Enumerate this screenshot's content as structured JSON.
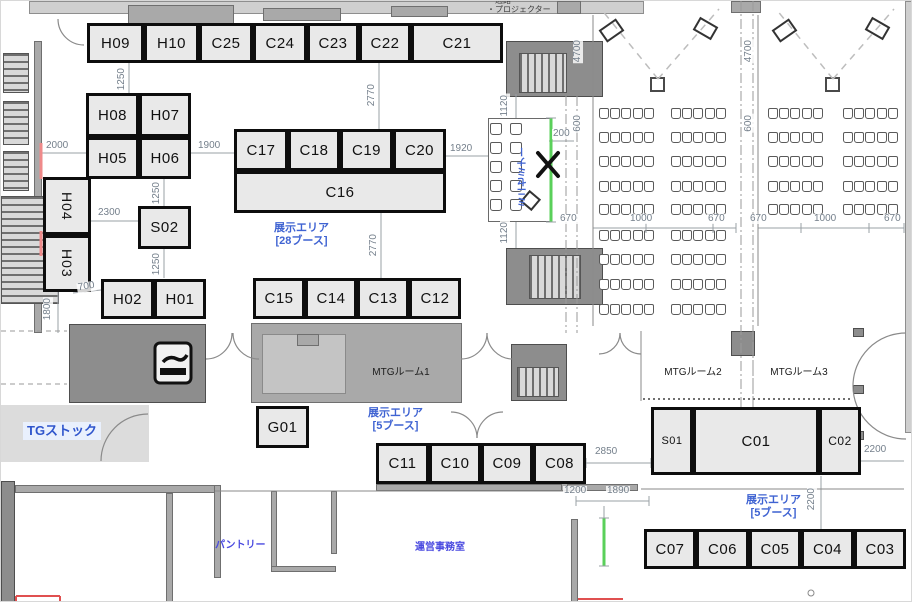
{
  "title": "展示エリア フロアマップ",
  "legend": {
    "line1": "・通路",
    "line2": "・プロジェクター"
  },
  "colors": {
    "booth_fill": "#e9e9e9",
    "booth_border": "#0d0d0d",
    "blue_label": "#3f63d2",
    "dim_text": "#75808c",
    "green_line": "#5ad05a",
    "red_accent": "#ef8a8a",
    "wall_dark": "#8d8d8d",
    "wall_mid": "#a9a9a9",
    "wall_light": "#cfcfcf"
  },
  "booths": [
    {
      "id": "H09",
      "x": 86,
      "y": 22,
      "w": 57,
      "h": 40
    },
    {
      "id": "H10",
      "x": 143,
      "y": 22,
      "w": 55,
      "h": 40
    },
    {
      "id": "C25",
      "x": 198,
      "y": 22,
      "w": 54,
      "h": 40
    },
    {
      "id": "C24",
      "x": 252,
      "y": 22,
      "w": 54,
      "h": 40
    },
    {
      "id": "C23",
      "x": 306,
      "y": 22,
      "w": 52,
      "h": 40
    },
    {
      "id": "C22",
      "x": 358,
      "y": 22,
      "w": 52,
      "h": 40
    },
    {
      "id": "C21",
      "x": 410,
      "y": 22,
      "w": 92,
      "h": 40
    },
    {
      "id": "H08",
      "x": 85,
      "y": 92,
      "w": 53,
      "h": 44
    },
    {
      "id": "H07",
      "x": 138,
      "y": 92,
      "w": 52,
      "h": 44
    },
    {
      "id": "H05",
      "x": 85,
      "y": 136,
      "w": 53,
      "h": 42
    },
    {
      "id": "H06",
      "x": 138,
      "y": 136,
      "w": 52,
      "h": 42
    },
    {
      "id": "H04",
      "x": 42,
      "y": 176,
      "w": 48,
      "h": 58,
      "vert": 1,
      "fs": 14
    },
    {
      "id": "H03",
      "x": 42,
      "y": 234,
      "w": 48,
      "h": 57,
      "vert": 1,
      "fs": 14
    },
    {
      "id": "S02",
      "x": 137,
      "y": 205,
      "w": 53,
      "h": 43
    },
    {
      "id": "H02",
      "x": 100,
      "y": 278,
      "w": 53,
      "h": 40
    },
    {
      "id": "H01",
      "x": 153,
      "y": 278,
      "w": 52,
      "h": 40
    },
    {
      "id": "C17",
      "x": 233,
      "y": 128,
      "w": 54,
      "h": 42
    },
    {
      "id": "C18",
      "x": 287,
      "y": 128,
      "w": 52,
      "h": 42
    },
    {
      "id": "C19",
      "x": 339,
      "y": 128,
      "w": 53,
      "h": 42
    },
    {
      "id": "C20",
      "x": 392,
      "y": 128,
      "w": 53,
      "h": 42
    },
    {
      "id": "C16",
      "x": 233,
      "y": 170,
      "w": 212,
      "h": 42
    },
    {
      "id": "C15",
      "x": 252,
      "y": 277,
      "w": 52,
      "h": 41
    },
    {
      "id": "C14",
      "x": 304,
      "y": 277,
      "w": 52,
      "h": 41
    },
    {
      "id": "C13",
      "x": 356,
      "y": 277,
      "w": 52,
      "h": 41
    },
    {
      "id": "C12",
      "x": 408,
      "y": 277,
      "w": 52,
      "h": 41
    },
    {
      "id": "G01",
      "x": 255,
      "y": 405,
      "w": 53,
      "h": 42
    },
    {
      "id": "C11",
      "x": 375,
      "y": 442,
      "w": 53,
      "h": 41
    },
    {
      "id": "C10",
      "x": 428,
      "y": 442,
      "w": 52,
      "h": 41
    },
    {
      "id": "C09",
      "x": 480,
      "y": 442,
      "w": 52,
      "h": 41
    },
    {
      "id": "C08",
      "x": 532,
      "y": 442,
      "w": 53,
      "h": 41
    },
    {
      "id": "S01",
      "x": 650,
      "y": 406,
      "w": 42,
      "h": 68,
      "fs": 11
    },
    {
      "id": "C01",
      "x": 692,
      "y": 406,
      "w": 126,
      "h": 68
    },
    {
      "id": "C02",
      "x": 818,
      "y": 406,
      "w": 42,
      "h": 68,
      "fs": 12
    },
    {
      "id": "C07",
      "x": 643,
      "y": 528,
      "w": 52,
      "h": 40
    },
    {
      "id": "C06",
      "x": 695,
      "y": 528,
      "w": 53,
      "h": 40
    },
    {
      "id": "C05",
      "x": 748,
      "y": 528,
      "w": 52,
      "h": 40
    },
    {
      "id": "C04",
      "x": 800,
      "y": 528,
      "w": 53,
      "h": 40
    },
    {
      "id": "C03",
      "x": 853,
      "y": 528,
      "w": 52,
      "h": 40
    }
  ],
  "rooms": [
    {
      "label": "MTGルーム1",
      "x": 355,
      "y": 362,
      "w": 90
    },
    {
      "label": "MTGルーム2",
      "x": 647,
      "y": 362,
      "w": 90
    },
    {
      "label": "MTGルーム3",
      "x": 753,
      "y": 362,
      "w": 90
    }
  ],
  "area_labels": [
    {
      "text": "展示エリア",
      "sub": "[28ブース]",
      "x": 258,
      "y": 221,
      "w": 85
    },
    {
      "text": "展示エリア",
      "sub": "[5ブース]",
      "x": 352,
      "y": 406,
      "w": 85
    },
    {
      "text": "展示エリア",
      "sub": "[5ブース]",
      "x": 730,
      "y": 493,
      "w": 85
    },
    {
      "text": "TGストック",
      "x": 22,
      "y": 421,
      "big": 1
    },
    {
      "text": "パントリー",
      "x": 214,
      "y": 539,
      "small": 1
    },
    {
      "text": "運営事務室",
      "x": 414,
      "y": 541,
      "small": 1
    },
    {
      "text": "ミニセミナー",
      "x": 517,
      "y": 146,
      "vert": 1
    }
  ],
  "dims": [
    {
      "text": "1250",
      "x": 116,
      "y": 66,
      "v": 1
    },
    {
      "text": "2000",
      "x": 44,
      "y": 140
    },
    {
      "text": "1900",
      "x": 196,
      "y": 140
    },
    {
      "text": "1250",
      "x": 151,
      "y": 180,
      "v": 1
    },
    {
      "text": "2300",
      "x": 96,
      "y": 207
    },
    {
      "text": "1250",
      "x": 151,
      "y": 251,
      "v": 1
    },
    {
      "text": "700",
      "x": 76,
      "y": 281,
      "slant": 1
    },
    {
      "text": "1800",
      "x": 42,
      "y": 296,
      "v": 1
    },
    {
      "text": "2770",
      "x": 366,
      "y": 82,
      "v": 1
    },
    {
      "text": "2770",
      "x": 368,
      "y": 232,
      "v": 1
    },
    {
      "text": "1920",
      "x": 448,
      "y": 143
    },
    {
      "text": "1120",
      "x": 499,
      "y": 93,
      "v": 1
    },
    {
      "text": "200",
      "x": 551,
      "y": 128
    },
    {
      "text": "1120",
      "x": 499,
      "y": 220,
      "v": 1
    },
    {
      "text": "4700",
      "x": 572,
      "y": 38,
      "v": 1
    },
    {
      "text": "600",
      "x": 572,
      "y": 113,
      "v": 1
    },
    {
      "text": "4700",
      "x": 743,
      "y": 38,
      "v": 1
    },
    {
      "text": "600",
      "x": 743,
      "y": 113,
      "v": 1
    },
    {
      "text": "670",
      "x": 558,
      "y": 213
    },
    {
      "text": "1000",
      "x": 628,
      "y": 213
    },
    {
      "text": "670",
      "x": 706,
      "y": 213
    },
    {
      "text": "670",
      "x": 748,
      "y": 213
    },
    {
      "text": "1000",
      "x": 812,
      "y": 213
    },
    {
      "text": "670",
      "x": 882,
      "y": 213
    },
    {
      "text": "2850",
      "x": 593,
      "y": 446
    },
    {
      "text": "1200",
      "x": 562,
      "y": 485
    },
    {
      "text": "1890",
      "x": 605,
      "y": 485
    },
    {
      "text": "2200",
      "x": 862,
      "y": 444
    },
    {
      "text": "2200",
      "x": 806,
      "y": 486,
      "v": 1
    }
  ],
  "walls": [
    {
      "x": 28,
      "y": 0,
      "w": 615,
      "h": 13,
      "s": "l"
    },
    {
      "x": 127,
      "y": 4,
      "w": 106,
      "h": 21,
      "s": "m"
    },
    {
      "x": 262,
      "y": 7,
      "w": 78,
      "h": 13,
      "s": "m"
    },
    {
      "x": 390,
      "y": 5,
      "w": 57,
      "h": 11,
      "s": "m"
    },
    {
      "x": 556,
      "y": 0,
      "w": 24,
      "h": 13,
      "s": "m"
    },
    {
      "x": 730,
      "y": 0,
      "w": 30,
      "h": 12,
      "s": "m"
    },
    {
      "x": 904,
      "y": 0,
      "w": 8,
      "h": 432,
      "s": "l"
    },
    {
      "x": 33,
      "y": 40,
      "w": 8,
      "h": 292,
      "s": "m"
    },
    {
      "x": 505,
      "y": 40,
      "w": 97,
      "h": 56,
      "s": "d"
    },
    {
      "x": 505,
      "y": 247,
      "w": 97,
      "h": 57,
      "s": "d"
    },
    {
      "x": 510,
      "y": 343,
      "w": 56,
      "h": 57,
      "s": "d"
    },
    {
      "x": 68,
      "y": 323,
      "w": 137,
      "h": 79,
      "s": "d"
    },
    {
      "x": 78,
      "y": 334,
      "w": 66,
      "h": 58,
      "s": "l"
    },
    {
      "x": 147,
      "y": 330,
      "w": 53,
      "h": 66,
      "s": "l"
    },
    {
      "x": 250,
      "y": 322,
      "w": 211,
      "h": 80,
      "s": "m"
    },
    {
      "x": 261,
      "y": 333,
      "w": 84,
      "h": 60,
      "s": "lg"
    },
    {
      "x": 296,
      "y": 333,
      "w": 22,
      "h": 12,
      "s": "m"
    },
    {
      "x": 349,
      "y": 330,
      "w": 107,
      "h": 66,
      "s": "l"
    },
    {
      "x": 0,
      "y": 404,
      "w": 148,
      "h": 57,
      "s": "tg"
    },
    {
      "x": 0,
      "y": 480,
      "w": 14,
      "h": 122,
      "s": "d"
    },
    {
      "x": 14,
      "y": 484,
      "w": 200,
      "h": 8,
      "s": "m"
    },
    {
      "x": 165,
      "y": 492,
      "w": 7,
      "h": 110,
      "s": "m"
    },
    {
      "x": 213,
      "y": 484,
      "w": 7,
      "h": 93,
      "s": "m"
    },
    {
      "x": 270,
      "y": 490,
      "w": 6,
      "h": 80,
      "s": "m"
    },
    {
      "x": 270,
      "y": 565,
      "w": 65,
      "h": 6,
      "s": "m"
    },
    {
      "x": 330,
      "y": 490,
      "w": 6,
      "h": 63,
      "s": "m"
    },
    {
      "x": 570,
      "y": 518,
      "w": 7,
      "h": 84,
      "s": "m"
    },
    {
      "x": 375,
      "y": 483,
      "w": 262,
      "h": 7,
      "s": "m"
    },
    {
      "x": 560,
      "y": 468,
      "w": 7,
      "h": 22,
      "s": "m"
    },
    {
      "x": 730,
      "y": 330,
      "w": 24,
      "h": 25,
      "s": "d"
    },
    {
      "x": 852,
      "y": 327,
      "w": 11,
      "h": 9,
      "s": "d"
    },
    {
      "x": 852,
      "y": 384,
      "w": 11,
      "h": 9,
      "s": "d"
    },
    {
      "x": 852,
      "y": 430,
      "w": 11,
      "h": 9,
      "s": "d"
    }
  ],
  "stairs": [
    {
      "x": 2,
      "y": 52,
      "w": 26,
      "h": 40,
      "dir": "h"
    },
    {
      "x": 2,
      "y": 100,
      "w": 26,
      "h": 44,
      "dir": "h"
    },
    {
      "x": 2,
      "y": 150,
      "w": 26,
      "h": 40,
      "dir": "h"
    },
    {
      "x": 0,
      "y": 195,
      "w": 58,
      "h": 108,
      "dir": "h"
    },
    {
      "x": 518,
      "y": 52,
      "w": 48,
      "h": 40,
      "dir": "v"
    },
    {
      "x": 528,
      "y": 254,
      "w": 52,
      "h": 44,
      "dir": "v"
    },
    {
      "x": 516,
      "y": 366,
      "w": 42,
      "h": 30,
      "dir": "v"
    }
  ],
  "seminars": [
    {
      "banks": [
        598,
        670
      ],
      "rows": [
        107,
        131,
        155,
        180,
        203,
        229,
        253,
        278,
        303
      ],
      "cols": 5,
      "size": 10,
      "step": 11.2
    },
    {
      "banks": [
        767,
        842
      ],
      "rows": [
        107,
        131,
        155,
        180,
        203
      ],
      "cols": 5,
      "size": 10,
      "step": 11.2
    }
  ],
  "mini": {
    "rect": {
      "x": 487,
      "y": 117,
      "w": 64,
      "h": 104
    },
    "cols": [
      489,
      509
    ],
    "rows": [
      122,
      141,
      160,
      179,
      198
    ],
    "size": 12
  },
  "projectors": [
    {
      "x": 649,
      "y": 76
    },
    {
      "x": 824,
      "y": 76
    }
  ],
  "screens": [
    {
      "x": 600,
      "y": 22,
      "r": -35,
      "w": 21,
      "h": 15
    },
    {
      "x": 694,
      "y": 20,
      "r": 30,
      "w": 21,
      "h": 15
    },
    {
      "x": 773,
      "y": 22,
      "r": -35,
      "w": 21,
      "h": 15
    },
    {
      "x": 866,
      "y": 20,
      "r": 30,
      "w": 21,
      "h": 15
    },
    {
      "x": 522,
      "y": 192,
      "r": 40,
      "w": 15,
      "h": 15
    }
  ],
  "lines": [
    [
      128,
      62,
      128,
      92,
      "dim"
    ],
    [
      40,
      152,
      85,
      152,
      "dim"
    ],
    [
      190,
      152,
      233,
      152,
      "dim"
    ],
    [
      163,
      178,
      163,
      205,
      "dim"
    ],
    [
      90,
      220,
      137,
      220,
      "dim"
    ],
    [
      163,
      248,
      163,
      277,
      "dim"
    ],
    [
      72,
      292,
      100,
      289,
      "dim"
    ],
    [
      57,
      291,
      57,
      332,
      "dim"
    ],
    [
      378,
      62,
      378,
      128,
      "dim"
    ],
    [
      380,
      212,
      380,
      277,
      "dim"
    ],
    [
      445,
      155,
      487,
      155,
      "dim"
    ],
    [
      515,
      93,
      515,
      117,
      "dim"
    ],
    [
      548,
      140,
      573,
      140,
      "dim"
    ],
    [
      515,
      221,
      515,
      247,
      "dim"
    ],
    [
      592,
      227,
      735,
      227,
      "dim"
    ],
    [
      757,
      227,
      903,
      227,
      "dim"
    ],
    [
      585,
      462,
      650,
      462,
      "dim"
    ],
    [
      575,
      500,
      648,
      500,
      "dim"
    ],
    [
      603,
      505,
      603,
      517,
      "dim"
    ],
    [
      860,
      460,
      903,
      460,
      "dim"
    ],
    [
      820,
      475,
      820,
      548,
      "dim"
    ],
    [
      592,
      222,
      592,
      232,
      "dim"
    ],
    [
      645,
      222,
      645,
      232,
      "dim"
    ],
    [
      712,
      222,
      712,
      232,
      "dim"
    ],
    [
      735,
      222,
      735,
      232,
      "dim"
    ],
    [
      757,
      222,
      757,
      232,
      "dim"
    ],
    [
      800,
      222,
      800,
      232,
      "dim"
    ],
    [
      868,
      222,
      868,
      232,
      "dim"
    ],
    [
      903,
      222,
      903,
      232,
      "dim"
    ],
    [
      575,
      495,
      575,
      505,
      "dim"
    ],
    [
      648,
      495,
      648,
      505,
      "dim"
    ],
    [
      585,
      457,
      585,
      467,
      "dim"
    ],
    [
      650,
      457,
      650,
      467,
      "dim"
    ],
    [
      592,
      14,
      592,
      325,
      "thin"
    ],
    [
      757,
      14,
      757,
      325,
      "thin"
    ],
    [
      640,
      330,
      640,
      400,
      "thin"
    ],
    [
      640,
      488,
      903,
      488,
      "thin"
    ],
    [
      214,
      490,
      570,
      490,
      "thin"
    ],
    [
      740,
      0,
      740,
      430,
      "dashdot"
    ],
    [
      752,
      0,
      752,
      430,
      "dashdot"
    ],
    [
      565,
      95,
      565,
      332,
      "dashdot"
    ],
    [
      576,
      95,
      576,
      332,
      "dashdot"
    ],
    [
      752,
      332,
      752,
      398,
      "dash"
    ],
    [
      0,
      330,
      66,
      330,
      "dash"
    ],
    [
      0,
      383,
      66,
      383,
      "dash"
    ],
    [
      642,
      398,
      850,
      398,
      "dot"
    ],
    [
      657,
      78,
      600,
      8,
      "dashp"
    ],
    [
      657,
      78,
      718,
      8,
      "dashp"
    ],
    [
      832,
      78,
      775,
      8,
      "dashp"
    ],
    [
      832,
      78,
      893,
      8,
      "dashp"
    ],
    [
      550,
      117,
      550,
      221,
      "green"
    ],
    [
      603,
      517,
      603,
      565,
      "green"
    ],
    [
      598,
      517,
      608,
      517,
      "dim"
    ],
    [
      598,
      565,
      608,
      565,
      "dim"
    ],
    [
      545,
      117,
      555,
      117,
      "dim"
    ],
    [
      545,
      221,
      555,
      221,
      "dim"
    ],
    [
      40,
      142,
      40,
      178,
      "red"
    ],
    [
      40,
      230,
      40,
      255,
      "red"
    ],
    [
      577,
      598,
      622,
      598,
      "redthin"
    ],
    [
      15,
      595,
      59,
      595,
      "redthin"
    ],
    [
      15,
      595,
      15,
      602,
      "redthin"
    ],
    [
      59,
      595,
      59,
      602,
      "redthin"
    ],
    [
      537,
      152,
      557,
      175,
      "black"
    ],
    [
      557,
      152,
      537,
      175,
      "black"
    ]
  ],
  "arcs": [
    "M57 18 A26 26 0 0 0 83 44",
    "M231 332 A26 26 0 0 1 205 358",
    "M232 332 A26 26 0 0 0 258 358",
    "M486 332 A26 26 0 0 1 460 358",
    "M486 332 A26 26 0 0 0 512 358",
    "M619 332 A21 21 0 0 1 598 353",
    "M619 332 A21 21 0 0 0 640 353",
    "M476 437 A26 26 0 0 0 450 411",
    "M476 437 A26 26 0 0 1 502 411",
    "M147 413 A47 47 0 0 0 100 460",
    "M905 332 A53 53 0 0 0 852 385",
    "M905 438 A53 53 0 0 1 852 385"
  ],
  "circles": [
    [
      810,
      592,
      3
    ]
  ]
}
